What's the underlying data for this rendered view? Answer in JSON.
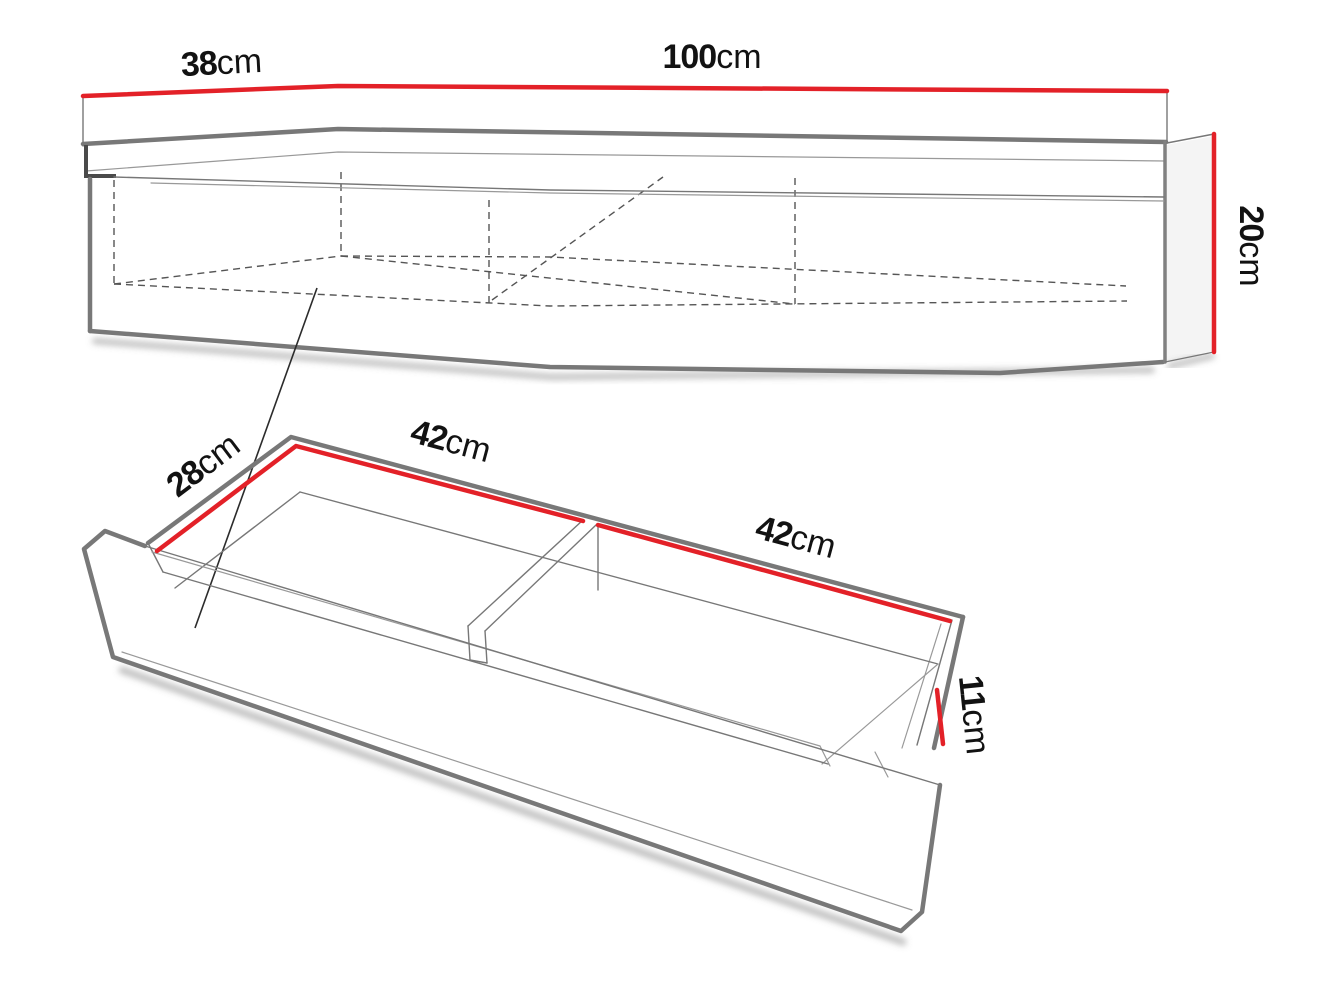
{
  "diagram": {
    "views": {
      "console": {
        "depth": {
          "value": "38",
          "unit": "cm"
        },
        "width": {
          "value": "100",
          "unit": "cm"
        },
        "height": {
          "value": "20",
          "unit": "cm"
        }
      },
      "drawer": {
        "depth": {
          "value": "28",
          "unit": "cm"
        },
        "left_compartment": {
          "value": "42",
          "unit": "cm"
        },
        "right_compartment": {
          "value": "42",
          "unit": "cm"
        },
        "height": {
          "value": "11",
          "unit": "cm"
        }
      }
    },
    "colors": {
      "dimension_highlight": "#e32128",
      "edge_gray": "#787878",
      "text": "#121212",
      "background": "#ffffff"
    }
  }
}
